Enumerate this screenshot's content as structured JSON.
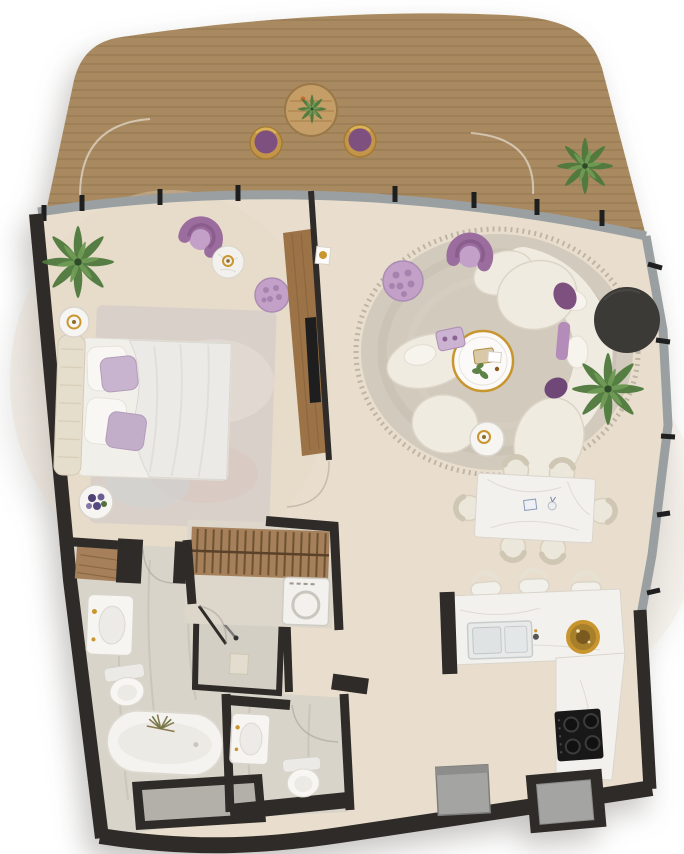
{
  "scene": {
    "type": "apartment-floor-plan-render",
    "view": "top-down",
    "background": "#ffffff"
  },
  "rooms": [
    {
      "name": "terrace",
      "items": [
        "curved wood deck",
        "round bistro table with plant",
        "two round chairs with purple cushions",
        "green potted plant",
        "glass balustrade with posts"
      ]
    },
    {
      "name": "bedroom",
      "items": [
        "double bed with white duvet",
        "tufted cream headboard",
        "two purple pillows",
        "two white pillows",
        "area rug",
        "round side table with gold tray",
        "round side table with purple flowers",
        "purple armchair",
        "round marble table with gold decor",
        "palm plant",
        "purple tufted pouf",
        "wood wardrobe niche"
      ]
    },
    {
      "name": "living-room",
      "items": [
        "large round rug with fringe",
        "curved cream sectional sofa",
        "purple armchair",
        "purple tufted pouf",
        "gold-rim round coffee table with tray and plant",
        "lavender tray",
        "dark round table",
        "palm plant",
        "white side table with gold cup",
        "purple throw cushions"
      ]
    },
    {
      "name": "dining-area",
      "items": [
        "white marble dining table",
        "six cream chairs",
        "two small table ornaments"
      ]
    },
    {
      "name": "kitchen",
      "items": [
        "L-shaped marble counter",
        "double sink with faucet",
        "gold bowl",
        "four-burner cooktop",
        "three bar stools",
        "gray appliance",
        "recessed gray unit"
      ]
    },
    {
      "name": "bathroom",
      "items": [
        "vanity with basin and gold faucet",
        "toilet",
        "freestanding oval bathtub",
        "dried plant on bathtub",
        "walk-in shower with glass door",
        "shower bench",
        "window ledge"
      ]
    },
    {
      "name": "wc",
      "items": [
        "toilet",
        "small vanity with gold faucet"
      ]
    },
    {
      "name": "walk-in-closet",
      "items": [
        "hanging rail with clothes",
        "washing machine"
      ]
    },
    {
      "name": "hallway",
      "items": []
    }
  ],
  "colors": {
    "wall": "#2f2b28",
    "deck_wood": "#a98a60",
    "deck_plank_line": "#846846",
    "deck_table": "#c59d66",
    "balustrade": "#9aa0a2",
    "post": "#1f1f1f",
    "floor": "#e9decd",
    "floor_warm": "#e6d6c6",
    "travertine": "#d8d4c9",
    "travertine_vein": "#c2bdaf",
    "rug_bedroom": "#d9d0c9",
    "rug_living": "#d2cabc",
    "rug_fringe": "#b7ae9d",
    "cream": "#f0ebe1",
    "cream_stroke": "#dcd5c6",
    "white_soft": "#f6f5f2",
    "fixture_stroke": "#d9d5cc",
    "duvet": "#ebeae6",
    "purple": "#9a6d9e",
    "purple_dark": "#7d5080",
    "lavender": "#c2a0c8",
    "lavender_light": "#c9b4cf",
    "gold": "#c9952f",
    "gold_dark": "#8f6a28",
    "marble": "#f3f1ed",
    "marble_vein": "#d9d5cd",
    "wood_panel": "#9b7347",
    "wood_closet": "#a5805a",
    "green": "#4f7a3d",
    "green_light": "#6f9b55",
    "dark_table": "#3b3a37",
    "cooktop": "#181818",
    "appliance": "#a4a4a2",
    "glass_inset": "#b3b0aa"
  }
}
